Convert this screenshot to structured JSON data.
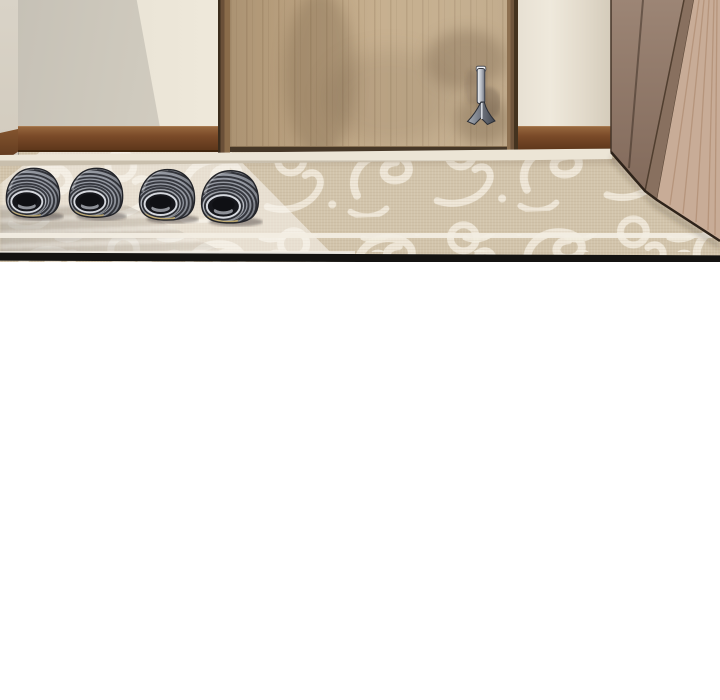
{
  "panel": {
    "type": "comic-panel",
    "alt": "Entryway interior: wooden front door with metal lever handle, beige walls with brown baseboard, wooden cabinet on the right, patterned beige rug, and two pairs of gray ribbed slippers on the floor",
    "objects": {
      "left_wall": "left wall",
      "right_wall": "wall right of the door",
      "baseboard": "brown baseboard",
      "door": "wooden front door",
      "door_frame": "dark wood door frame",
      "door_handle": "metal lever door handle",
      "threshold": "door threshold step",
      "cabinet": "wooden shoe cabinet",
      "rug": "beige rug with white scroll pattern",
      "rug_border": "white border lines of the rug",
      "slippers": "two pairs of gray striped slippers",
      "slipper_count": "4",
      "panel_border": "black panel bottom border",
      "blank_area": "white space below the panel"
    },
    "palette": {
      "background": "#ffffff",
      "wall_left": "#c6c1b6",
      "wall_light": "#efe9db",
      "wall_right": "#efe9dc",
      "baseboard": "#7a4a28",
      "door_wood": "#c4ac8a",
      "door_frame_dark": "#3a2c1c",
      "cabinet_front": "#9c8575",
      "cabinet_side": "#c8ac97",
      "rug_base": "#d2c4ab",
      "rug_pattern": "#f3eee3",
      "slipper_dark": "#36383f",
      "slipper_light": "#969aa3",
      "slipper_sole": "#c8b277",
      "handle_metal": "#f1f3f6",
      "panel_border": "#141311"
    }
  }
}
